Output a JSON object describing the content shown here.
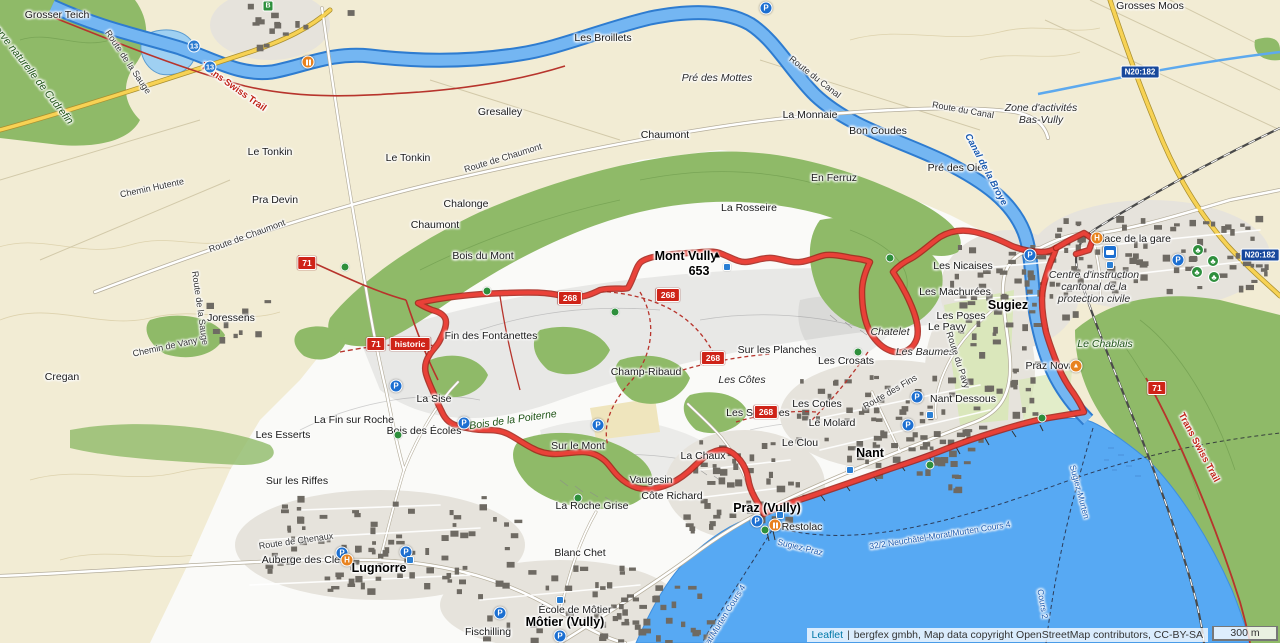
{
  "map": {
    "attribution": {
      "leaflet": "Leaflet",
      "separator": "|",
      "text": "bergfex gmbh, Map data copyright OpenStreetMap contributors, CC-BY-SA"
    },
    "scale_label": "300 m",
    "labels": [
      {
        "text": "Sugiez",
        "x": 1008,
        "y": 305,
        "cls": "town"
      },
      {
        "text": "Nant",
        "x": 870,
        "y": 453,
        "cls": "town"
      },
      {
        "text": "Praz (Vully)",
        "x": 767,
        "y": 508,
        "cls": "town"
      },
      {
        "text": "Môtier (Vully)",
        "x": 565,
        "y": 622,
        "cls": "town"
      },
      {
        "text": "Lugnorre",
        "x": 379,
        "y": 568,
        "cls": "town"
      },
      {
        "text": "Mont Vully",
        "x": 686,
        "y": 256,
        "cls": "town"
      },
      {
        "text": "653",
        "x": 699,
        "y": 271,
        "cls": "town"
      },
      {
        "text": "Grosser Teich",
        "x": 57,
        "y": 15,
        "cls": "locality"
      },
      {
        "text": "Les Broillets",
        "x": 603,
        "y": 38,
        "cls": "locality"
      },
      {
        "text": "Grosses Moos",
        "x": 1150,
        "y": 6,
        "cls": "locality"
      },
      {
        "text": "Gresalley",
        "x": 500,
        "y": 112,
        "cls": "locality"
      },
      {
        "text": "Chaumont",
        "x": 665,
        "y": 135,
        "cls": "locality"
      },
      {
        "text": "Le Tonkin",
        "x": 270,
        "y": 152,
        "cls": "locality"
      },
      {
        "text": "Le Tonkin",
        "x": 408,
        "y": 158,
        "cls": "locality"
      },
      {
        "text": "La Monnaie",
        "x": 810,
        "y": 115,
        "cls": "locality"
      },
      {
        "text": "Bon Coudes",
        "x": 878,
        "y": 131,
        "cls": "locality"
      },
      {
        "text": "Pré des Oies",
        "x": 958,
        "y": 168,
        "cls": "locality"
      },
      {
        "text": "Pra Devin",
        "x": 275,
        "y": 200,
        "cls": "locality"
      },
      {
        "text": "Chalonge",
        "x": 466,
        "y": 204,
        "cls": "locality"
      },
      {
        "text": "Chaumont",
        "x": 435,
        "y": 225,
        "cls": "locality"
      },
      {
        "text": "Joressens",
        "x": 231,
        "y": 318,
        "cls": "locality"
      },
      {
        "text": "En Ferruz",
        "x": 834,
        "y": 178,
        "cls": "locality"
      },
      {
        "text": "La Rosseire",
        "x": 749,
        "y": 208,
        "cls": "locality"
      },
      {
        "text": "Bois du Mont",
        "x": 483,
        "y": 256,
        "cls": "locality"
      },
      {
        "text": "Fin des Fontanettes",
        "x": 491,
        "y": 336,
        "cls": "locality"
      },
      {
        "text": "La Sise",
        "x": 434,
        "y": 399,
        "cls": "locality"
      },
      {
        "text": "La Fin sur Roche",
        "x": 354,
        "y": 420,
        "cls": "locality"
      },
      {
        "text": "Les Esserts",
        "x": 283,
        "y": 435,
        "cls": "locality"
      },
      {
        "text": "Bois des Écoles",
        "x": 424,
        "y": 431,
        "cls": "locality"
      },
      {
        "text": "Sur le Mont",
        "x": 578,
        "y": 446,
        "cls": "locality"
      },
      {
        "text": "Champ-Ribaud",
        "x": 646,
        "y": 372,
        "cls": "locality"
      },
      {
        "text": "Sur les Planches",
        "x": 777,
        "y": 350,
        "cls": "locality"
      },
      {
        "text": "Les Crosats",
        "x": 846,
        "y": 361,
        "cls": "locality"
      },
      {
        "text": "Les Coties",
        "x": 817,
        "y": 404,
        "cls": "locality"
      },
      {
        "text": "Les Souplées",
        "x": 758,
        "y": 413,
        "cls": "locality"
      },
      {
        "text": "Le Molard",
        "x": 832,
        "y": 423,
        "cls": "locality"
      },
      {
        "text": "Le Clou",
        "x": 800,
        "y": 443,
        "cls": "locality"
      },
      {
        "text": "Nant Dessous",
        "x": 963,
        "y": 399,
        "cls": "locality"
      },
      {
        "text": "Les Nicaises",
        "x": 963,
        "y": 266,
        "cls": "locality"
      },
      {
        "text": "Les Machurées",
        "x": 955,
        "y": 292,
        "cls": "locality"
      },
      {
        "text": "Les Poses",
        "x": 961,
        "y": 316,
        "cls": "locality"
      },
      {
        "text": "Le Pavy",
        "x": 947,
        "y": 327,
        "cls": "locality"
      },
      {
        "text": "Sur les Riffes",
        "x": 297,
        "y": 481,
        "cls": "locality"
      },
      {
        "text": "Cregan",
        "x": 62,
        "y": 377,
        "cls": "locality"
      },
      {
        "text": "La Roche Grise",
        "x": 592,
        "y": 506,
        "cls": "locality"
      },
      {
        "text": "Blanc Chet",
        "x": 580,
        "y": 553,
        "cls": "locality"
      },
      {
        "text": "Vaugesin",
        "x": 651,
        "y": 480,
        "cls": "locality"
      },
      {
        "text": "Côte Richard",
        "x": 672,
        "y": 496,
        "cls": "locality"
      },
      {
        "text": "La Chaux",
        "x": 703,
        "y": 456,
        "cls": "locality"
      },
      {
        "text": "Fischilling",
        "x": 488,
        "y": 632,
        "cls": "locality"
      },
      {
        "text": "Auberge des Clefs",
        "x": 305,
        "y": 560,
        "cls": "locality"
      },
      {
        "text": "Restolac",
        "x": 802,
        "y": 527,
        "cls": "locality"
      },
      {
        "text": "Place de la gare",
        "x": 1133,
        "y": 239,
        "cls": "locality"
      },
      {
        "text": "Praz Nova",
        "x": 1050,
        "y": 366,
        "cls": "locality"
      },
      {
        "text": "École de Môtier",
        "x": 575,
        "y": 610,
        "cls": "locality"
      },
      {
        "text": "Pré des Mottes",
        "x": 717,
        "y": 78,
        "cls": "area"
      },
      {
        "text": "Zone d'activités\nBas-Vully",
        "x": 1041,
        "y": 114,
        "cls": "area"
      },
      {
        "text": "Centre d'instruction\ncantonal de la\nprotection civile",
        "x": 1094,
        "y": 287,
        "cls": "area"
      },
      {
        "text": "Chatelet",
        "x": 890,
        "y": 332,
        "cls": "area"
      },
      {
        "text": "Les Baumes",
        "x": 925,
        "y": 352,
        "cls": "area"
      },
      {
        "text": "Les Côtes",
        "x": 742,
        "y": 380,
        "cls": "area"
      },
      {
        "text": "Bois de la Poiterne",
        "x": 513,
        "y": 420,
        "cls": "green",
        "rot": -8
      },
      {
        "text": "Le Chablais",
        "x": 1105,
        "y": 344,
        "cls": "green"
      },
      {
        "text": "Réserve naturelle de Cudrefin",
        "x": 28,
        "y": 68,
        "cls": "green",
        "rot": 52
      },
      {
        "text": "Route de la Sauge",
        "x": 128,
        "y": 62,
        "cls": "street",
        "rot": 56
      },
      {
        "text": "Route de la Sauge",
        "x": 200,
        "y": 308,
        "cls": "street",
        "rot": 82
      },
      {
        "text": "Route de Chaumont",
        "x": 503,
        "y": 158,
        "cls": "street",
        "rot": -17
      },
      {
        "text": "Route de Chaumont",
        "x": 247,
        "y": 236,
        "cls": "street",
        "rot": -20
      },
      {
        "text": "Chemin de Vany",
        "x": 165,
        "y": 347,
        "cls": "street",
        "rot": -12
      },
      {
        "text": "Chemin Hutente",
        "x": 152,
        "y": 188,
        "cls": "street",
        "rot": -12
      },
      {
        "text": "Route de Chenaux",
        "x": 296,
        "y": 541,
        "cls": "street",
        "rot": -8
      },
      {
        "text": "Route du Pavy",
        "x": 958,
        "y": 360,
        "cls": "street",
        "rot": 72
      },
      {
        "text": "Route des Fins",
        "x": 890,
        "y": 392,
        "cls": "street",
        "rot": -30
      },
      {
        "text": "Route du Canal",
        "x": 815,
        "y": 77,
        "cls": "street",
        "rot": 38
      },
      {
        "text": "Route du Canal",
        "x": 963,
        "y": 110,
        "cls": "street",
        "rot": 10
      },
      {
        "text": "Canal de la Broye",
        "x": 985,
        "y": 170,
        "cls": "water",
        "rot": 62
      },
      {
        "text": "Sugiez-Murten",
        "x": 1079,
        "y": 492,
        "cls": "ferry",
        "rot": 75
      },
      {
        "text": "Sugiez-Praz",
        "x": 800,
        "y": 548,
        "cls": "ferry",
        "rot": 14
      },
      {
        "text": "32/2 Neuchâtel-Morat/Murten Cours 4",
        "x": 940,
        "y": 536,
        "cls": "ferry",
        "rot": -9
      },
      {
        "text": "Morat/Murten Cours 4",
        "x": 722,
        "y": 621,
        "cls": "ferry",
        "rot": -58
      },
      {
        "text": "Cours 2",
        "x": 1042,
        "y": 604,
        "cls": "ferry",
        "rot": 80
      },
      {
        "text": "Trans Swiss Trail",
        "x": 233,
        "y": 88,
        "cls": "trail",
        "rot": 35
      },
      {
        "text": "Trans Swiss Trail",
        "x": 1198,
        "y": 448,
        "cls": "trail",
        "rot": 62
      }
    ],
    "badges": [
      {
        "text": "268",
        "x": 570,
        "y": 298,
        "kind": "route"
      },
      {
        "text": "268",
        "x": 668,
        "y": 295,
        "kind": "route"
      },
      {
        "text": "268",
        "x": 713,
        "y": 358,
        "kind": "route"
      },
      {
        "text": "268",
        "x": 766,
        "y": 412,
        "kind": "route"
      },
      {
        "text": "71",
        "x": 307,
        "y": 263,
        "kind": "route"
      },
      {
        "text": "71",
        "x": 376,
        "y": 344,
        "kind": "route"
      },
      {
        "text": "71",
        "x": 1157,
        "y": 388,
        "kind": "route"
      },
      {
        "text": "historic",
        "x": 410,
        "y": 344,
        "kind": "route"
      },
      {
        "text": "N20:182",
        "x": 1140,
        "y": 72,
        "kind": "road"
      },
      {
        "text": "N20:182",
        "x": 1260,
        "y": 255,
        "kind": "road"
      },
      {
        "text": "13",
        "x": 194,
        "y": 46,
        "kind": "water"
      },
      {
        "text": "13",
        "x": 210,
        "y": 67,
        "kind": "water"
      }
    ],
    "markers": [
      {
        "type": "summit",
        "x": 717,
        "y": 255
      },
      {
        "type": "parking",
        "x": 396,
        "y": 386
      },
      {
        "type": "parking",
        "x": 464,
        "y": 423
      },
      {
        "type": "parking",
        "x": 598,
        "y": 425
      },
      {
        "type": "parking",
        "x": 908,
        "y": 425
      },
      {
        "type": "parking",
        "x": 342,
        "y": 553
      },
      {
        "type": "parking",
        "x": 406,
        "y": 552
      },
      {
        "type": "parking",
        "x": 500,
        "y": 613
      },
      {
        "type": "parking",
        "x": 560,
        "y": 636
      },
      {
        "type": "parking",
        "x": 1030,
        "y": 255
      },
      {
        "type": "parking",
        "x": 1178,
        "y": 260
      },
      {
        "type": "parking",
        "x": 766,
        "y": 8
      },
      {
        "type": "parking",
        "x": 917,
        "y": 397
      },
      {
        "type": "parking",
        "x": 757,
        "y": 521
      },
      {
        "type": "stop",
        "x": 615,
        "y": 312
      },
      {
        "type": "stop",
        "x": 398,
        "y": 435
      },
      {
        "type": "stop",
        "x": 578,
        "y": 498
      },
      {
        "type": "stop",
        "x": 858,
        "y": 352
      },
      {
        "type": "stop",
        "x": 890,
        "y": 258
      },
      {
        "type": "stop",
        "x": 487,
        "y": 291
      },
      {
        "type": "stop",
        "x": 765,
        "y": 530
      },
      {
        "type": "stop",
        "x": 930,
        "y": 465
      },
      {
        "type": "stop",
        "x": 345,
        "y": 267
      },
      {
        "type": "stop",
        "x": 1042,
        "y": 418
      },
      {
        "type": "tree",
        "x": 1198,
        "y": 250
      },
      {
        "type": "tree",
        "x": 1213,
        "y": 261
      },
      {
        "type": "tree",
        "x": 1197,
        "y": 272
      },
      {
        "type": "tree",
        "x": 1214,
        "y": 277
      },
      {
        "type": "info",
        "x": 727,
        "y": 267
      },
      {
        "type": "info",
        "x": 780,
        "y": 515
      },
      {
        "type": "info",
        "x": 930,
        "y": 415
      },
      {
        "type": "info",
        "x": 850,
        "y": 470
      },
      {
        "type": "info",
        "x": 560,
        "y": 600
      },
      {
        "type": "info",
        "x": 1110,
        "y": 265
      },
      {
        "type": "info",
        "x": 410,
        "y": 560
      },
      {
        "type": "hotel",
        "x": 347,
        "y": 560
      },
      {
        "type": "hotel",
        "x": 1097,
        "y": 238
      },
      {
        "type": "restaurant",
        "x": 775,
        "y": 525
      },
      {
        "type": "restaurant",
        "x": 308,
        "y": 62
      },
      {
        "type": "camp",
        "x": 1076,
        "y": 366
      },
      {
        "type": "station",
        "x": 1110,
        "y": 252
      },
      {
        "type": "transit",
        "x": 268,
        "y": 6
      }
    ]
  }
}
